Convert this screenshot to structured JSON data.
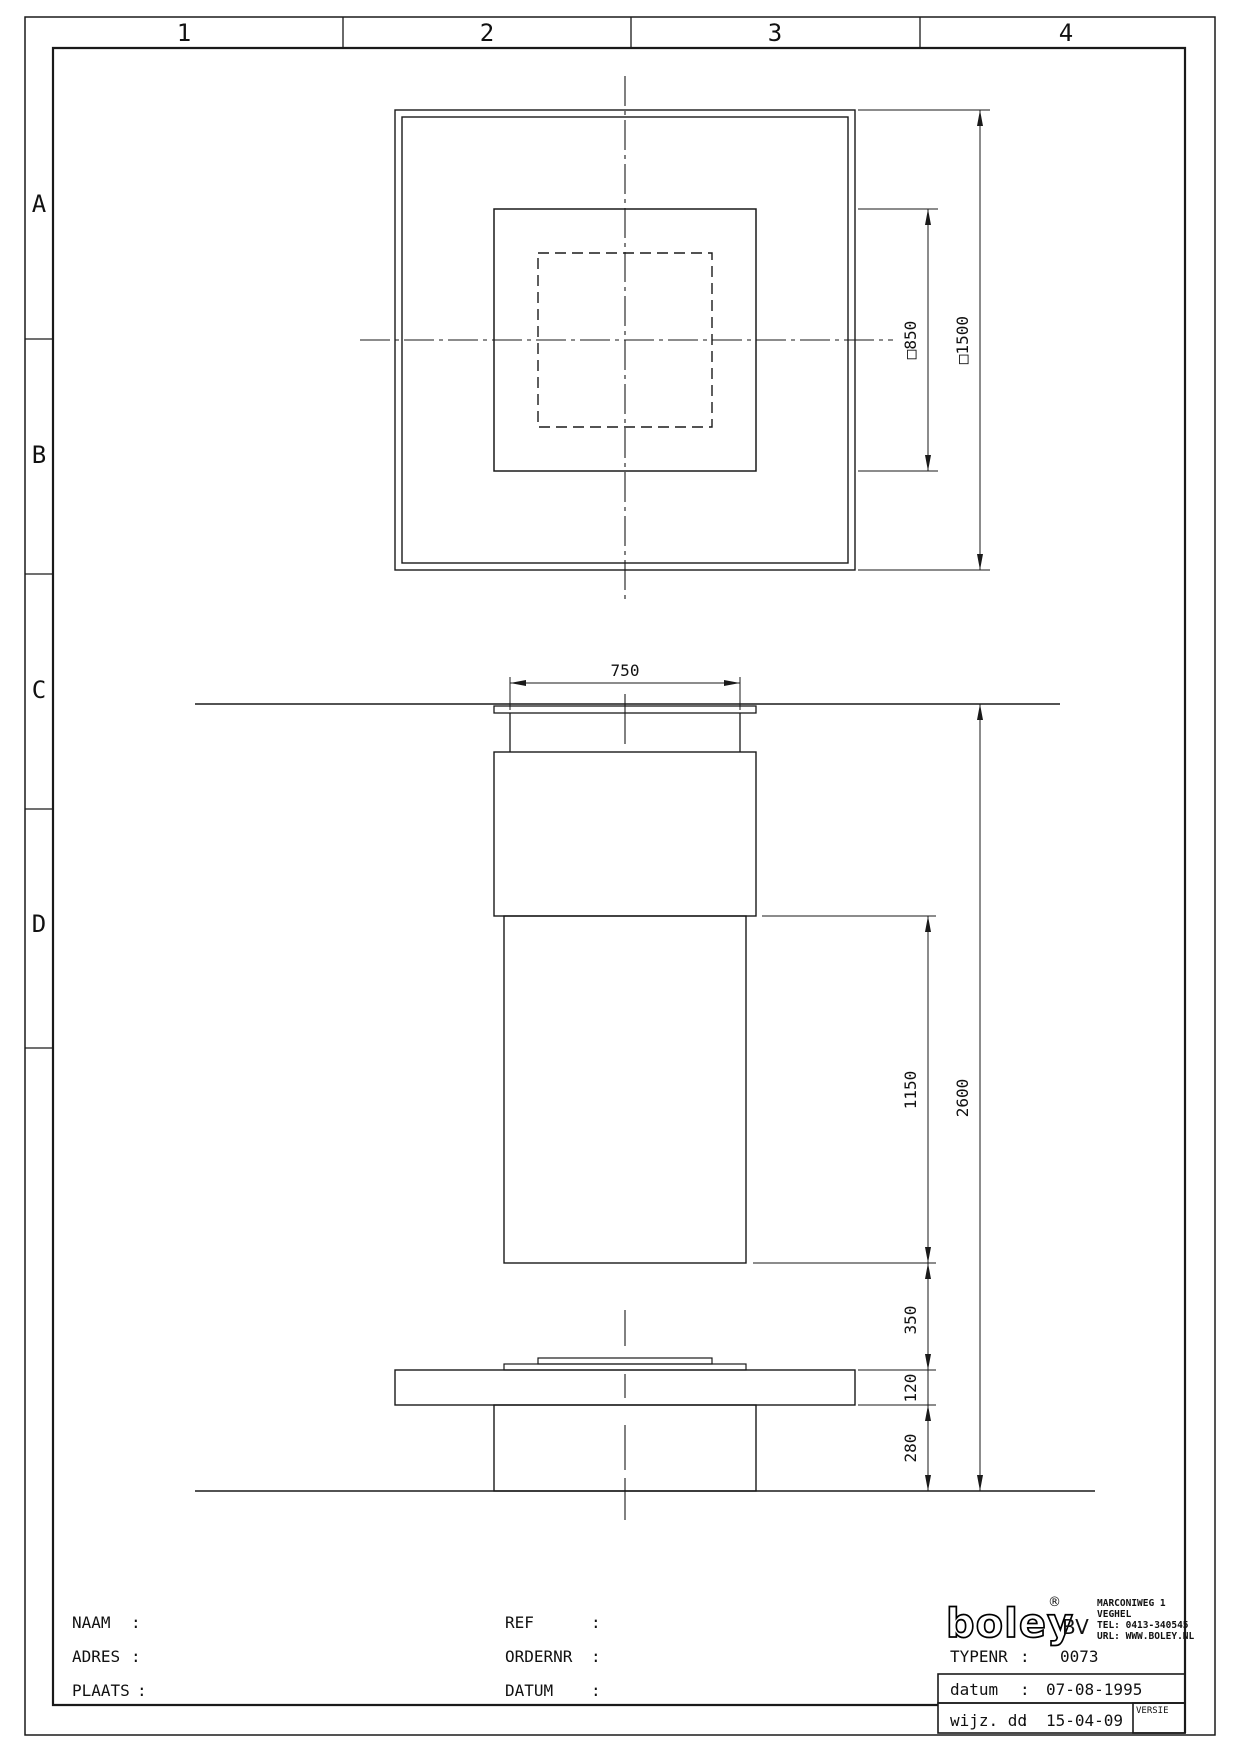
{
  "sheet": {
    "grid_columns": [
      "1",
      "2",
      "3",
      "4"
    ],
    "grid_rows": [
      "A",
      "B",
      "C",
      "D"
    ]
  },
  "plan_view": {
    "dim_outer_square": "□1500",
    "dim_middle_square": "□850"
  },
  "elevation_view": {
    "dim_top_width": "750",
    "dim_column_height": "1150",
    "dim_overall_height": "2600",
    "dim_gap": "350",
    "dim_slab_thickness": "120",
    "dim_pedestal_height": "280"
  },
  "title_block": {
    "colon": ":",
    "naam_label": "NAAM",
    "adres_label": "ADRES",
    "plaats_label": "PLAATS",
    "ref_label": "REF",
    "ordernr_label": "ORDERNR",
    "datum_label": "DATUM",
    "logo_text": "boley",
    "logo_reg": "®",
    "logo_bv": "BV",
    "address_line1": "MARCONIWEG 1",
    "address_line2": "VEGHEL",
    "address_line3": "TEL: 0413-340545",
    "address_line4": "URL: WWW.BOLEY.NL",
    "typenr_label": "TYPENR",
    "typenr_value": "0073",
    "datum_row_label": "datum",
    "datum_row_value": "07-08-1995",
    "wijz_row_label": "wijz. dd",
    "wijz_row_value": "15-04-09",
    "versie_label": "VERSIE"
  }
}
